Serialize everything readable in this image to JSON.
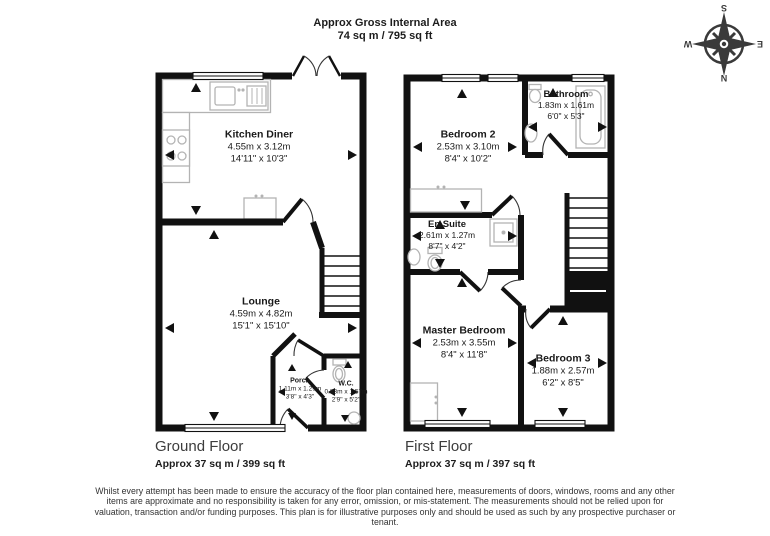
{
  "header": {
    "title": "Approx Gross Internal Area",
    "subtitle": "74 sq m / 795 sq ft"
  },
  "compass": {
    "top": "S",
    "bottom": "N",
    "left": "E",
    "right": "W"
  },
  "ground_floor": {
    "label": "Ground Floor",
    "area": "Approx 37 sq m / 399 sq ft",
    "rooms": [
      {
        "name": "Kitchen Diner",
        "metric": "4.55m x 3.12m",
        "imperial": "14'11\" x 10'3\""
      },
      {
        "name": "Lounge",
        "metric": "4.59m x 4.82m",
        "imperial": "15'1\" x 15'10\""
      },
      {
        "name": "Porch",
        "metric": "1.11m x 1.29m",
        "imperial": "3'8\" x 4'3\""
      },
      {
        "name": "W.C.",
        "metric": "0.83m x 1.57m",
        "imperial": "2'9\" x 5'2\""
      }
    ]
  },
  "first_floor": {
    "label": "First Floor",
    "area": "Approx 37 sq m / 397 sq ft",
    "rooms": [
      {
        "name": "Bedroom 2",
        "metric": "2.53m x 3.10m",
        "imperial": "8'4\" x 10'2\""
      },
      {
        "name": "Bathroom",
        "metric": "1.83m x 1.61m",
        "imperial": "6'0\" x 5'3\""
      },
      {
        "name": "En Suite",
        "metric": "2.61m x 1.27m",
        "imperial": "8'7\" x 4'2\""
      },
      {
        "name": "Master Bedroom",
        "metric": "2.53m x 3.55m",
        "imperial": "8'4\" x 11'8\""
      },
      {
        "name": "Bedroom 3",
        "metric": "1.88m x 2.57m",
        "imperial": "6'2\" x 8'5\""
      }
    ]
  },
  "disclaimer": "Whilst every attempt has been made to ensure the accuracy of the floor plan contained here, measurements of doors, windows, rooms and any other items are approximate and no responsibility is taken for any error, omission, or mis-statement. The measurements should not be relied upon for valuation, transaction and/or funding purposes. This plan is for illustrative purposes only and should be used as such by any prospective purchaser or tenant."
}
